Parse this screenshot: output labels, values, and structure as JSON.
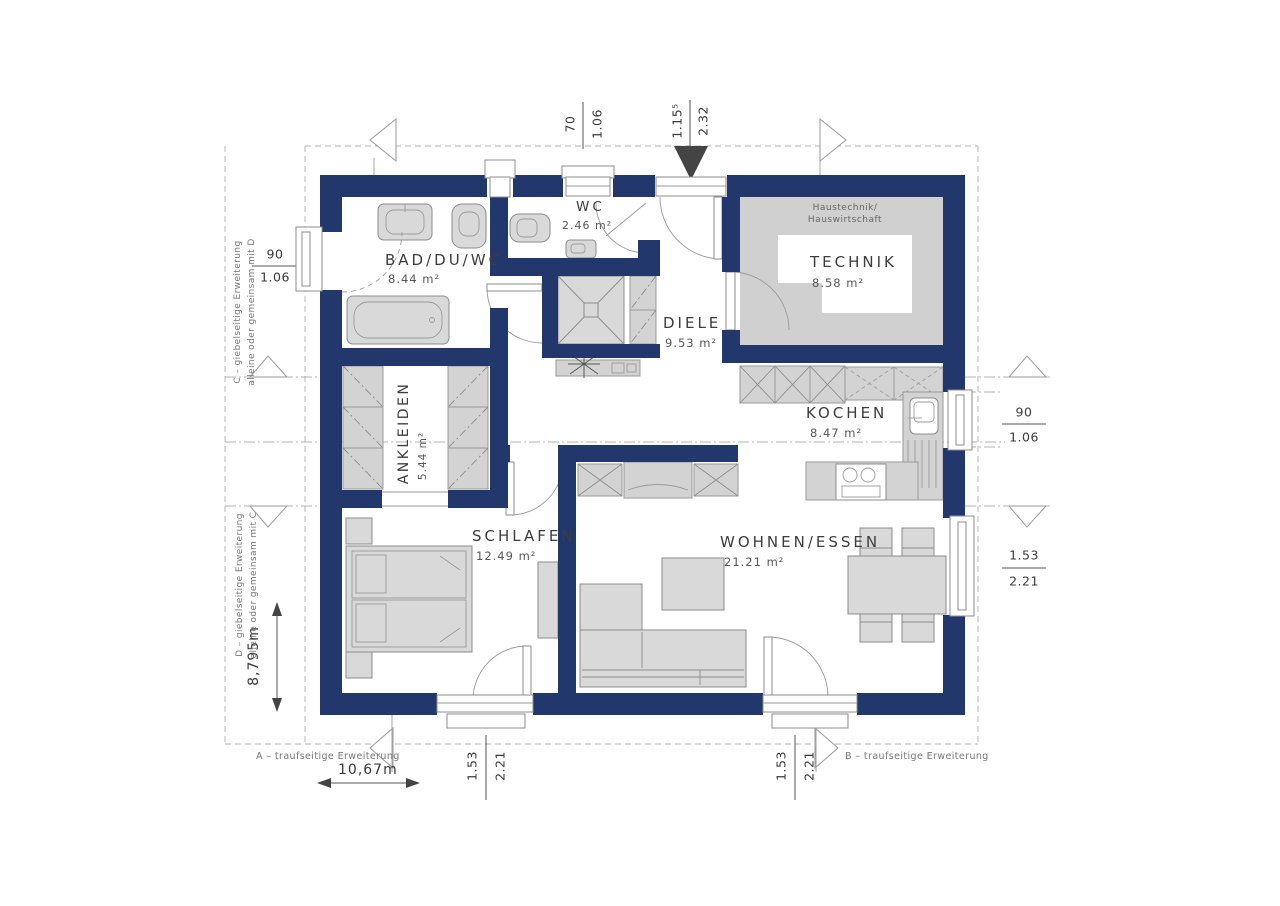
{
  "plan": {
    "rooms": {
      "bad": {
        "name": "BAD/DU/WC",
        "area": "8.44 m²"
      },
      "wc": {
        "name": "WC",
        "area": "2.46 m²"
      },
      "technik": {
        "name": "TECHNIK",
        "area": "8.58 m²",
        "note1": "Haustechnik/",
        "note2": "Hauswirtschaft"
      },
      "diele": {
        "name": "DIELE",
        "area": "9.53 m²"
      },
      "kochen": {
        "name": "KOCHEN",
        "area": "8.47 m²"
      },
      "ankleiden": {
        "name": "ANKLEIDEN",
        "area": "5.44 m²"
      },
      "schlafen": {
        "name": "SCHLAFEN",
        "area": "12.49 m²"
      },
      "wohnen": {
        "name": "WOHNEN/ESSEN",
        "area": "21.21 m²"
      }
    },
    "dims": {
      "top_window": {
        "a": "70",
        "b": "1.06"
      },
      "entry": {
        "a": "1.15⁵",
        "b": "2.32"
      },
      "left_window": {
        "a": "90",
        "b": "1.06"
      },
      "kitchen_window": {
        "a": "90",
        "b": "1.06"
      },
      "living_window": {
        "a": "1.53",
        "b": "2.21"
      },
      "schlafen_door": {
        "a": "1.53",
        "b": "2.21"
      },
      "wohnen_door": {
        "a": "1.53",
        "b": "2.21"
      },
      "total_height": "8,795m",
      "total_width": "10,67m"
    },
    "extensions": {
      "a": "A – traufseitige Erweiterung",
      "b": "B – traufseitige Erweiterung",
      "c_line1": "C – giebelseitige Erweiterung",
      "c_line2": "alleine oder gemeinsam mit D",
      "d_line1": "D – giebelseitige Erweiterung",
      "d_line2": "alleine oder gemeinsam mit C"
    },
    "colors": {
      "wall": "#22376b",
      "furniture": "#d9d9d9",
      "line": "#8c8c8c"
    }
  }
}
